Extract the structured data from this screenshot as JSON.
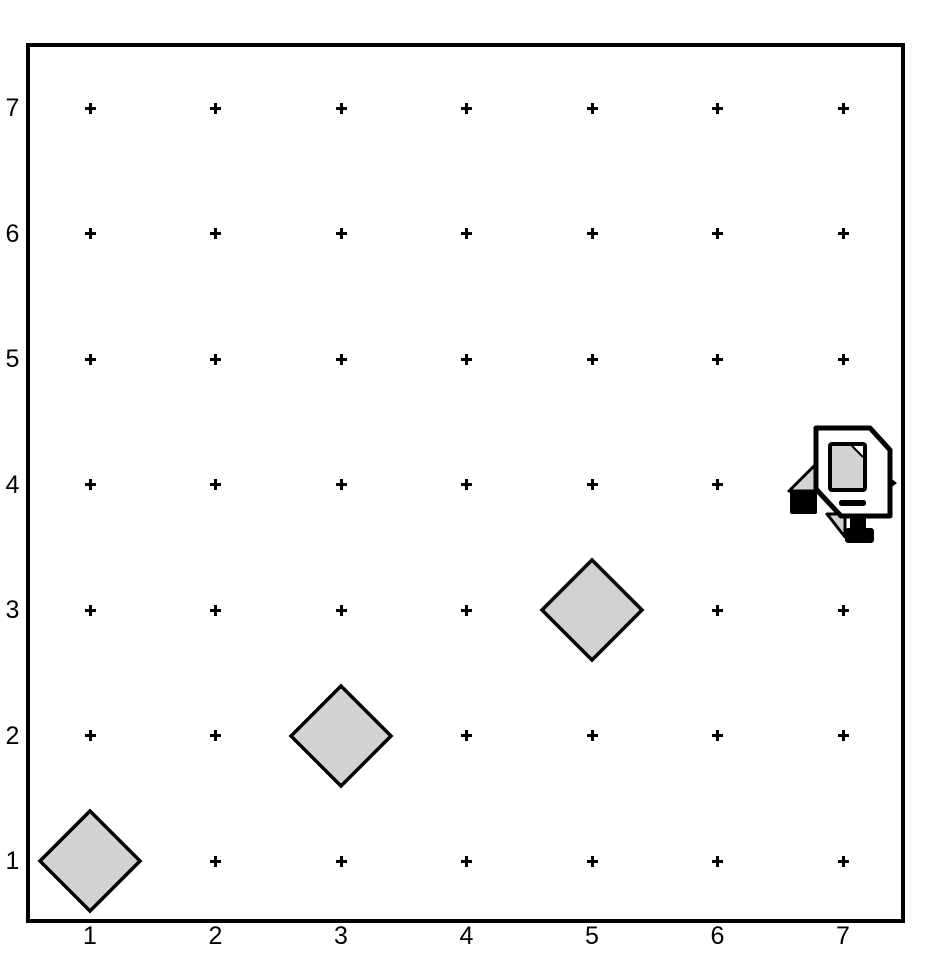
{
  "scene": {
    "kind": "robot-world-grid",
    "background_color": "#ffffff",
    "outline_color": "#000000"
  },
  "axes": {
    "x_labels": [
      "1",
      "2",
      "3",
      "4",
      "5",
      "6",
      "7"
    ],
    "y_labels": [
      "7",
      "6",
      "5",
      "4",
      "3",
      "2",
      "1"
    ]
  },
  "grid": {
    "columns": 7,
    "rows": 7,
    "marker_glyph": "+",
    "marker_color": "#000000"
  },
  "things": [
    {
      "type": "diamond",
      "col": 1,
      "row": 1
    },
    {
      "type": "diamond",
      "col": 3,
      "row": 2
    },
    {
      "type": "diamond",
      "col": 5,
      "row": 3
    }
  ],
  "robot": {
    "col": 7,
    "row": 4,
    "facing": "east"
  },
  "colors": {
    "thing_fill": "#d3d3d3",
    "robot_body_fill": "#ffffff",
    "robot_screen_fill": "#d3d3d3",
    "outline": "#000000"
  }
}
